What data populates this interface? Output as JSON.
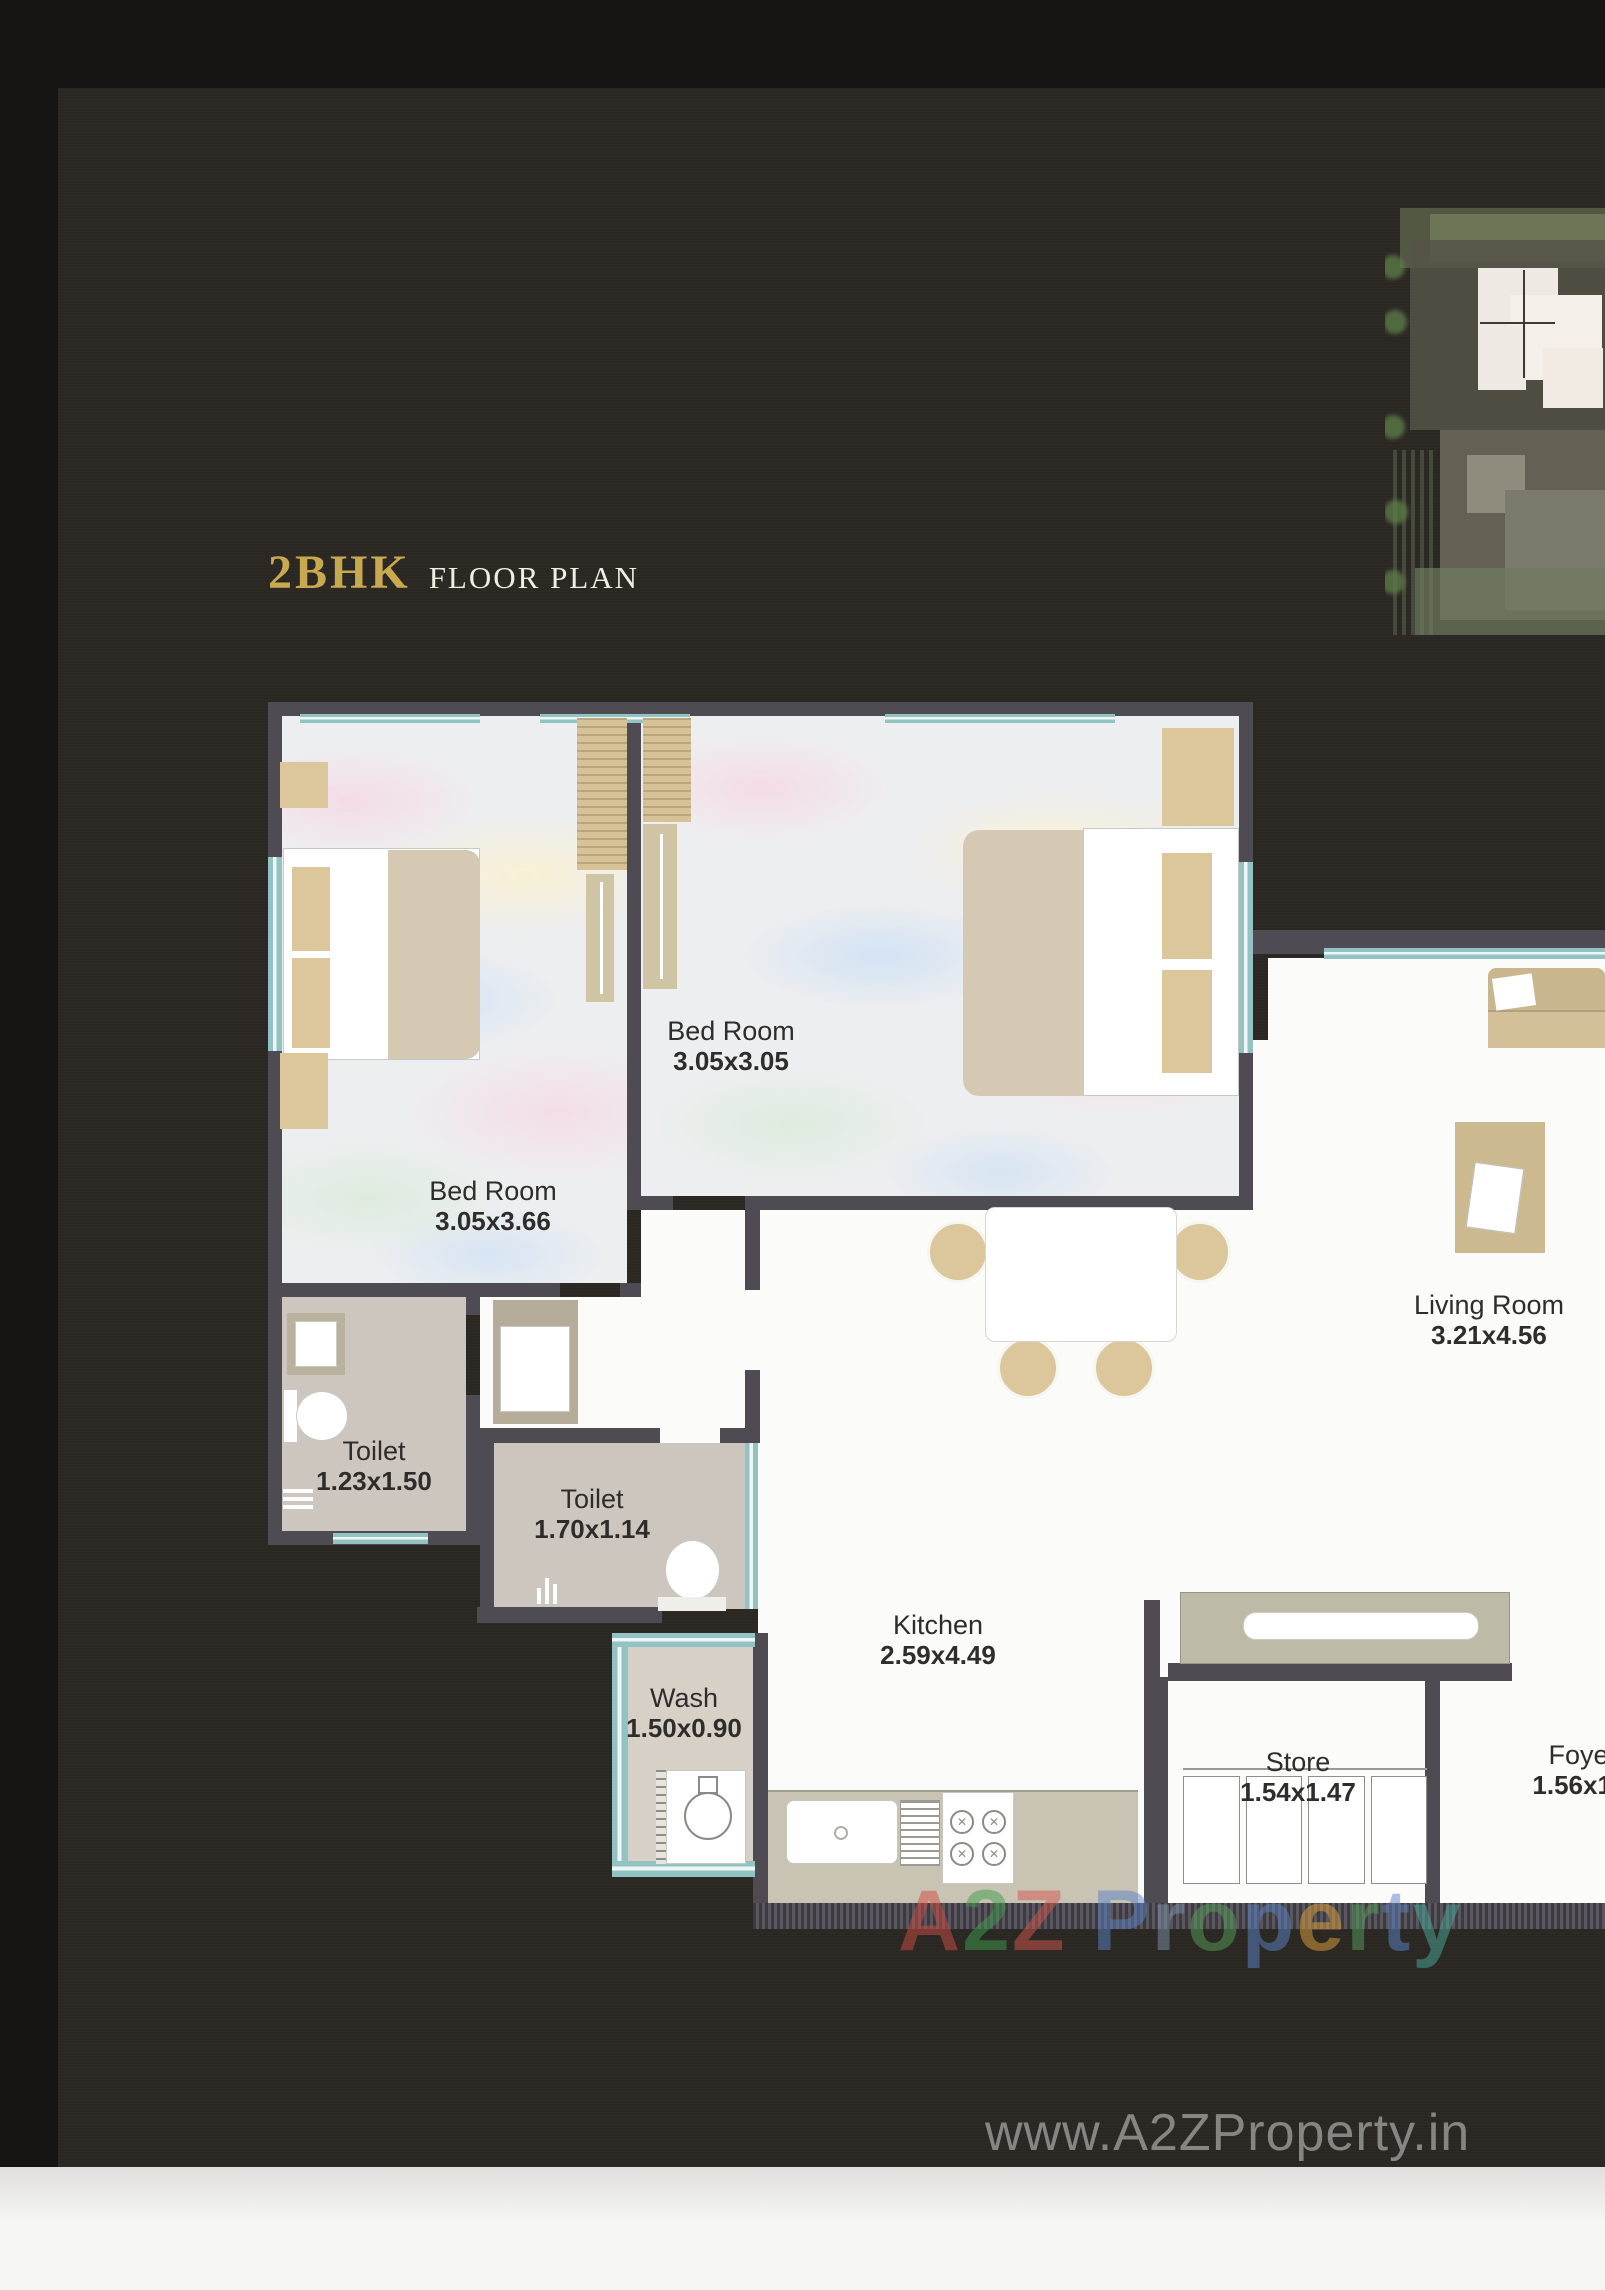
{
  "page": {
    "title_main": "2BHK",
    "title_sub": "FLOOR PLAN"
  },
  "rooms": [
    {
      "id": "bedroom-1",
      "name": "Bed Room",
      "dimensions": "3.05x3.66"
    },
    {
      "id": "bedroom-2",
      "name": "Bed Room",
      "dimensions": "3.05x3.05"
    },
    {
      "id": "toilet-1",
      "name": "Toilet",
      "dimensions": "1.23x1.50"
    },
    {
      "id": "toilet-2",
      "name": "Toilet",
      "dimensions": "1.70x1.14"
    },
    {
      "id": "wash",
      "name": "Wash",
      "dimensions": "1.50x0.90"
    },
    {
      "id": "kitchen",
      "name": "Kitchen",
      "dimensions": "2.59x4.49"
    },
    {
      "id": "living-room",
      "name": "Living Room",
      "dimensions": "3.21x4.56"
    },
    {
      "id": "store",
      "name": "Store",
      "dimensions": "1.54x1.47"
    },
    {
      "id": "foyer",
      "name": "Foyer",
      "dimensions": "1.56x1.4"
    }
  ],
  "watermarks": {
    "center": {
      "text": "A2Z Property",
      "letters": [
        {
          "ch": "A",
          "color": "#cf4b42"
        },
        {
          "ch": "2",
          "color": "#3f9e4d"
        },
        {
          "ch": "Z",
          "color": "#d4564e"
        },
        {
          "ch": " ",
          "color": "#888888"
        },
        {
          "ch": "P",
          "color": "#5b84c6"
        },
        {
          "ch": "r",
          "color": "#7d93a8"
        },
        {
          "ch": "o",
          "color": "#57a05a"
        },
        {
          "ch": "p",
          "color": "#5b84c6"
        },
        {
          "ch": "e",
          "color": "#e2a23e"
        },
        {
          "ch": "r",
          "color": "#57a05a"
        },
        {
          "ch": "t",
          "color": "#5b84c6"
        },
        {
          "ch": "y",
          "color": "#49ab9b"
        }
      ]
    },
    "bottom": "www.A2ZProperty.in"
  },
  "colors": {
    "accent_gold": "#c9a94f",
    "wall": "#4f4b52",
    "window_teal": "#93c2c2",
    "floor_white": "#fbfbf9",
    "floor_toilet": "#cdc6be",
    "furniture_tan": "#dcc69c",
    "counter_olive": "#bdbaa8"
  }
}
